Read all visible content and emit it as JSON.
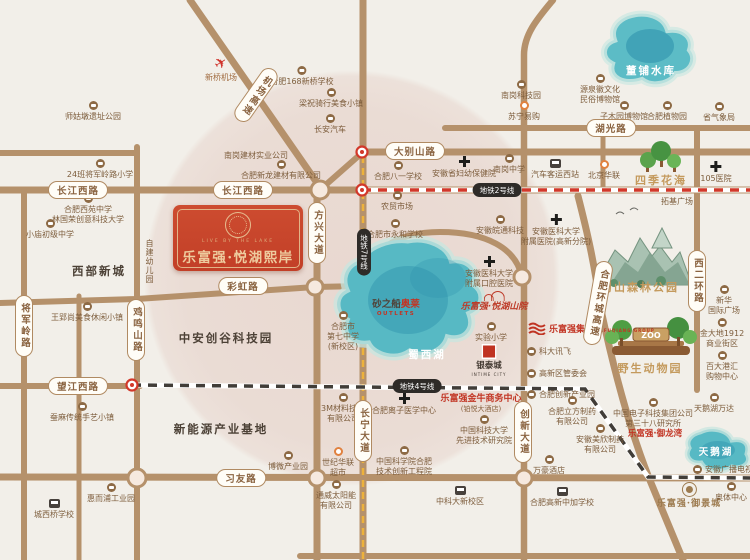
{
  "project": {
    "name": "乐富强·悦湖熙岸",
    "tagline": "LIVE BY THE LAKE"
  },
  "colors": {
    "brand_red": "#c5422b",
    "road_tan": "#b5916b",
    "lake_teal": "#57b9c4",
    "metro2_red": "#d2382a",
    "metro4_dark": "#413d38",
    "metro7_yellow": "#edb23c",
    "gold": "#c49a5d",
    "blush_pink": "#d8afa4"
  },
  "pills": {
    "dabieshan": "大别山路",
    "changjiangxi": "长江西路",
    "caihong": "彩虹路",
    "wangjiangxi": "望江西路",
    "xiyou": "习友路",
    "huguang": "湖光路",
    "fangxing": "方兴大道",
    "jiangjunling": "将军岭路",
    "jimingshan": "鸡鸣山路",
    "changning": "长宁大道",
    "chuangxin": "创新大道",
    "xierhuan": "西二环路",
    "huancheng": "合肥环城高速",
    "jichang": "机场高速"
  },
  "metro": {
    "line2": "地铁2号线",
    "line4": "地铁4号线",
    "line7": "地铁7号线"
  },
  "lakes": {
    "dongpu": "董铺水库",
    "shuxi": "蜀西湖",
    "tiane": "天鹅湖"
  },
  "zones": {
    "xibu": "西部新城",
    "zhongan": "中安创谷科技园",
    "xinnengyuan": "新能源产业基地",
    "siji": "四季花海",
    "shushan": "蜀山森林公园",
    "zoo": "野生动物园",
    "zoo_sign": "ZOO"
  },
  "brand": {
    "shanyuan": "乐富强·悦湖山院",
    "group": "乐富强集团",
    "group_en": "LEFUQIANG GROUP",
    "jinniu": "乐富强金牛商务中心",
    "jinniu_sub": "(铂悦大酒店)",
    "yulongwan": "乐富强·御龙湾",
    "yujingcheng": "乐富强·御景城",
    "intime": "银泰城",
    "intime_en": "INTIME CITY",
    "sha": "砂之船",
    "aolai": "奥莱",
    "outlets": "OUTLETS"
  },
  "pois": {
    "shigudun": "师姑墩遗址公园",
    "xinqiao": "新桥机场",
    "jiangjunxiaoxue": "24班将军岭路小学",
    "hefei168": "合肥168新桥学校",
    "liangzhu": "梁祝骑行美食小镇",
    "changan": "长安汽车",
    "nangangjiancai": "南岗建材实业公司",
    "xinlong": "合肥新龙建材有限公司",
    "bayi": "合肥八一学校",
    "fuyou": "安徽省妇幼保健院",
    "nangangzhongxue": "南岗中学",
    "keyunxizhan": "汽车客运西站",
    "nangangkeji": "南岗科技园",
    "suning": "苏宁易购",
    "yuanquan": "源泉徽文化\n民俗博物馆",
    "zimuyuan": "子木园博物馆",
    "zhiwuyuan": "合肥植物园",
    "qixiangju": "省气象局",
    "y105": "105医院",
    "bjhualian": "北京华联",
    "tuoji": "拓基广场",
    "xinhua": "新华\n国际广场",
    "jindadi": "金大地1912\n商业街区",
    "baida": "百大港汇\n购物中心",
    "wanda": "天鹅湖万达",
    "dianke38": "中国电子科技集团公司\n第三十八研究所",
    "guangdian": "安徽广播电视台",
    "aoti": "奥体中心",
    "meixin": "安徽美欣制药\n有限公司",
    "nongmao": "农贸市场",
    "yonghe": "合肥市永和学校",
    "wantong": "安徽皖通科技",
    "yifuyuan": "安徽医科大学\n附属医院(高新分院)",
    "kouqiang": "安徽医科大学\n附属口腔医院",
    "qizhong": "合肥市\n第七中学\n(新校区)",
    "shiyan": "实验小学",
    "kedaxunfei": "科大讯飞",
    "guanweihui": "高新区管委会",
    "chanyeyuan": "合肥创新产业园",
    "lizi": "合肥离子医学中心",
    "zhongkeda": "中国科技大学\n先进技术研究院",
    "gongchengyuan": "中国科学院合肥\n技术创新工程院",
    "wanhao": "万豪酒店",
    "lifang": "合肥立方制药\n有限公司",
    "xinxiaoqu": "中科大新校区",
    "zhongjia": "合肥高新中加学校",
    "m3": "3M材料技术\n有限公司",
    "shijihualian": "世纪华联\n超市",
    "tongwei": "通威太阳能\n有限公司",
    "bowei": "博微产业园",
    "huierpu": "惠而浦工业园",
    "chengxiqiao": "城西桥学校",
    "wangying": "王郢尚美食休闲小镇",
    "canma": "蚕麻传统手艺小镇",
    "xiaomiao": "小庙初级中学",
    "xiyuan": "合肥西苑中学\n林国荣创意科技大学",
    "youeryuan": "自建幼儿园"
  }
}
